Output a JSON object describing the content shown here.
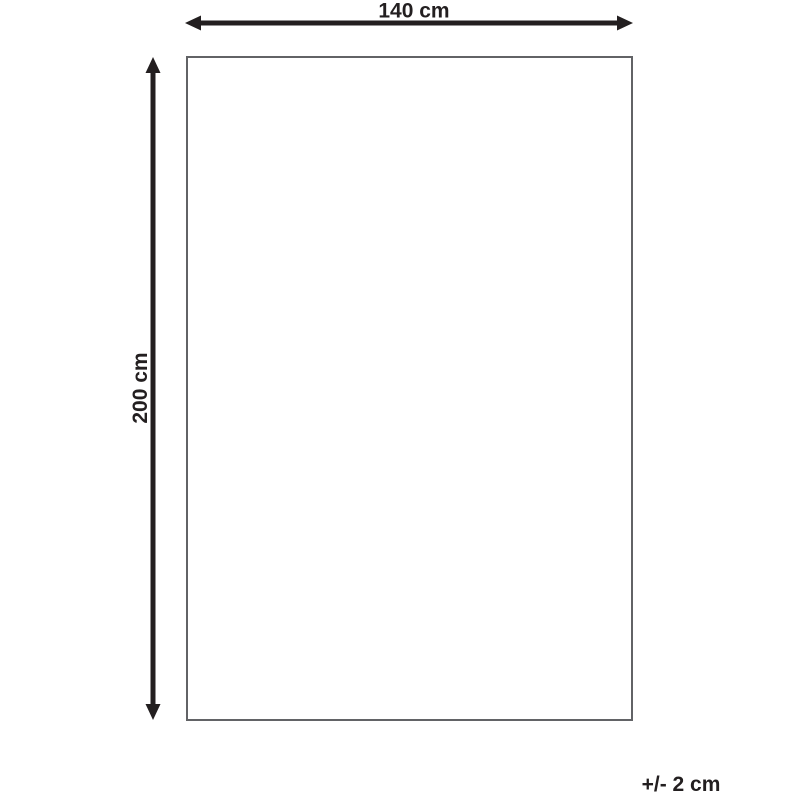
{
  "diagram": {
    "width_label": "140 cm",
    "height_label": "200 cm",
    "tolerance_label": "+/- 2 cm",
    "width_value_cm": 140,
    "height_value_cm": 200,
    "tolerance_value_cm": 2,
    "ink_color": "#231f20",
    "outline_color": "#626366",
    "background_color": "#ffffff"
  }
}
